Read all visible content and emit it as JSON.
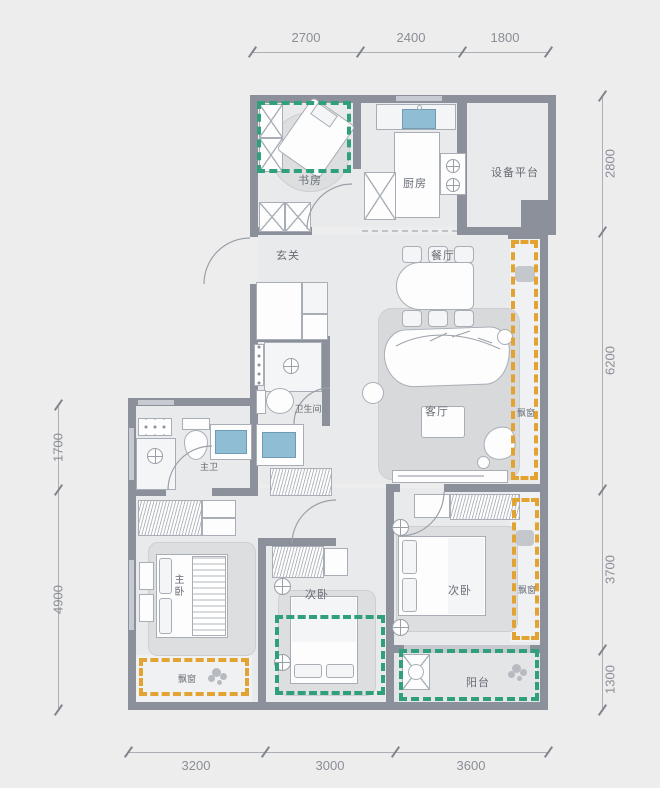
{
  "rooms": {
    "study": "书房",
    "kitchen": "厨房",
    "equipment_platform": "设备平台",
    "foyer": "玄关",
    "dining": "餐厅",
    "living": "客厅",
    "guest_bath": "卫生间",
    "master_bath": "主卫",
    "master_bedroom": "主卧",
    "bedroom2": "次卧",
    "bedroom3": "次卧",
    "balcony": "阳台",
    "bay_window_living": "飘窗",
    "bay_window_bedroom3": "飘窗",
    "bay_window_master": "飘窗"
  },
  "dimensions_mm": {
    "top": [
      "2700",
      "2400",
      "1800"
    ],
    "right": [
      "2800",
      "6200",
      "3700",
      "1300"
    ],
    "left": [
      "1700",
      "4900"
    ],
    "bottom": [
      "3200",
      "3000",
      "3600"
    ]
  },
  "colors": {
    "wall": "#8b909a",
    "highlight_green": "#2fa079",
    "highlight_orange": "#e2a333",
    "fixture_blue": "#8fbdd3"
  }
}
